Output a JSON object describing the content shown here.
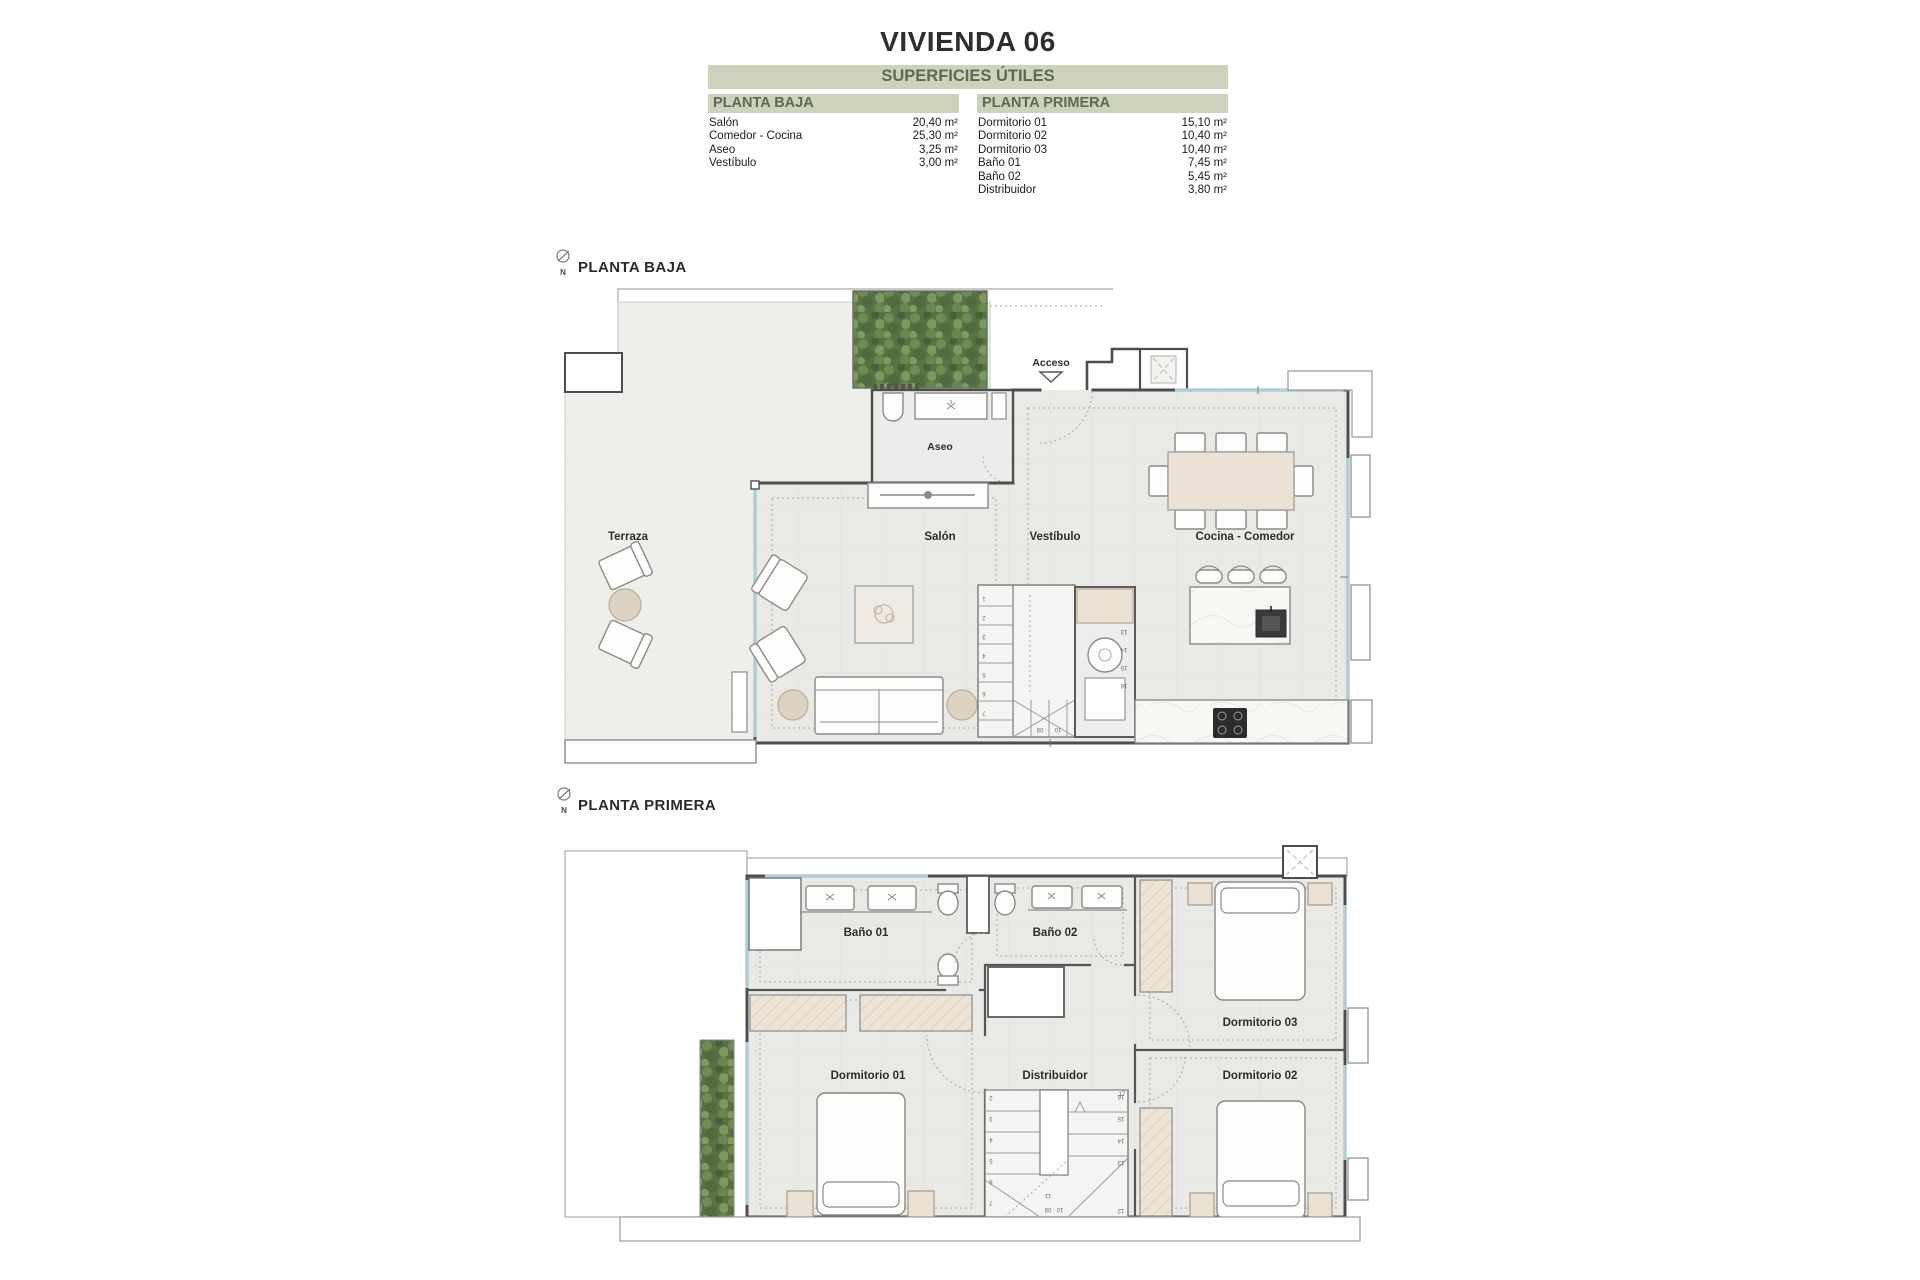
{
  "document": {
    "title": "VIVIENDA 06",
    "surfaces": {
      "header": "SUPERFICIES ÚTILES",
      "columns": [
        {
          "header": "PLANTA BAJA",
          "rows": [
            {
              "label": "Salón",
              "value": "20,40 m²"
            },
            {
              "label": "Comedor - Cocina",
              "value": "25,30 m²"
            },
            {
              "label": "Aseo",
              "value": "3,25 m²"
            },
            {
              "label": "Vestíbulo",
              "value": "3,00 m²"
            }
          ]
        },
        {
          "header": "PLANTA PRIMERA",
          "rows": [
            {
              "label": "Dormitorio 01",
              "value": "15,10 m²"
            },
            {
              "label": "Dormitorio 02",
              "value": "10,40 m²"
            },
            {
              "label": "Dormitorio 03",
              "value": "10,40 m²"
            },
            {
              "label": "Baño 01",
              "value": "7,45 m²"
            },
            {
              "label": "Baño 02",
              "value": "5,45 m²"
            },
            {
              "label": "Distribuidor",
              "value": "3,80 m²"
            }
          ]
        }
      ]
    }
  },
  "plans": {
    "ground": {
      "name": "PLANTA BAJA",
      "compass": "N",
      "rooms": {
        "terraza": "Terraza",
        "aseo": "Aseo",
        "acceso": "Acceso",
        "salon": "Salón",
        "vestibulo": "Vestíbulo",
        "cocina": "Cocina - Comedor"
      },
      "stair_numbers": [
        "1",
        "2",
        "3",
        "4",
        "5",
        "6",
        "7",
        "09",
        "10",
        "11",
        "13",
        "14",
        "15",
        "16"
      ]
    },
    "first": {
      "name": "PLANTA PRIMERA",
      "compass": "N",
      "rooms": {
        "bano1": "Baño 01",
        "bano2": "Baño 02",
        "dorm1": "Dormitorio 01",
        "dorm2": "Dormitorio 02",
        "dorm3": "Dormitorio 03",
        "distribuidor": "Distribuidor"
      },
      "stair_numbers": [
        "2",
        "3",
        "4",
        "5",
        "6",
        "7",
        "09",
        "10",
        "11",
        "12",
        "13",
        "14",
        "15",
        "16",
        "17"
      ]
    }
  },
  "colors": {
    "band_green": "#ccd3ba",
    "glazing_blue": "#aecdd4",
    "floor_gray": "#e9eae6",
    "accent_beige": "#ebe1d3"
  }
}
